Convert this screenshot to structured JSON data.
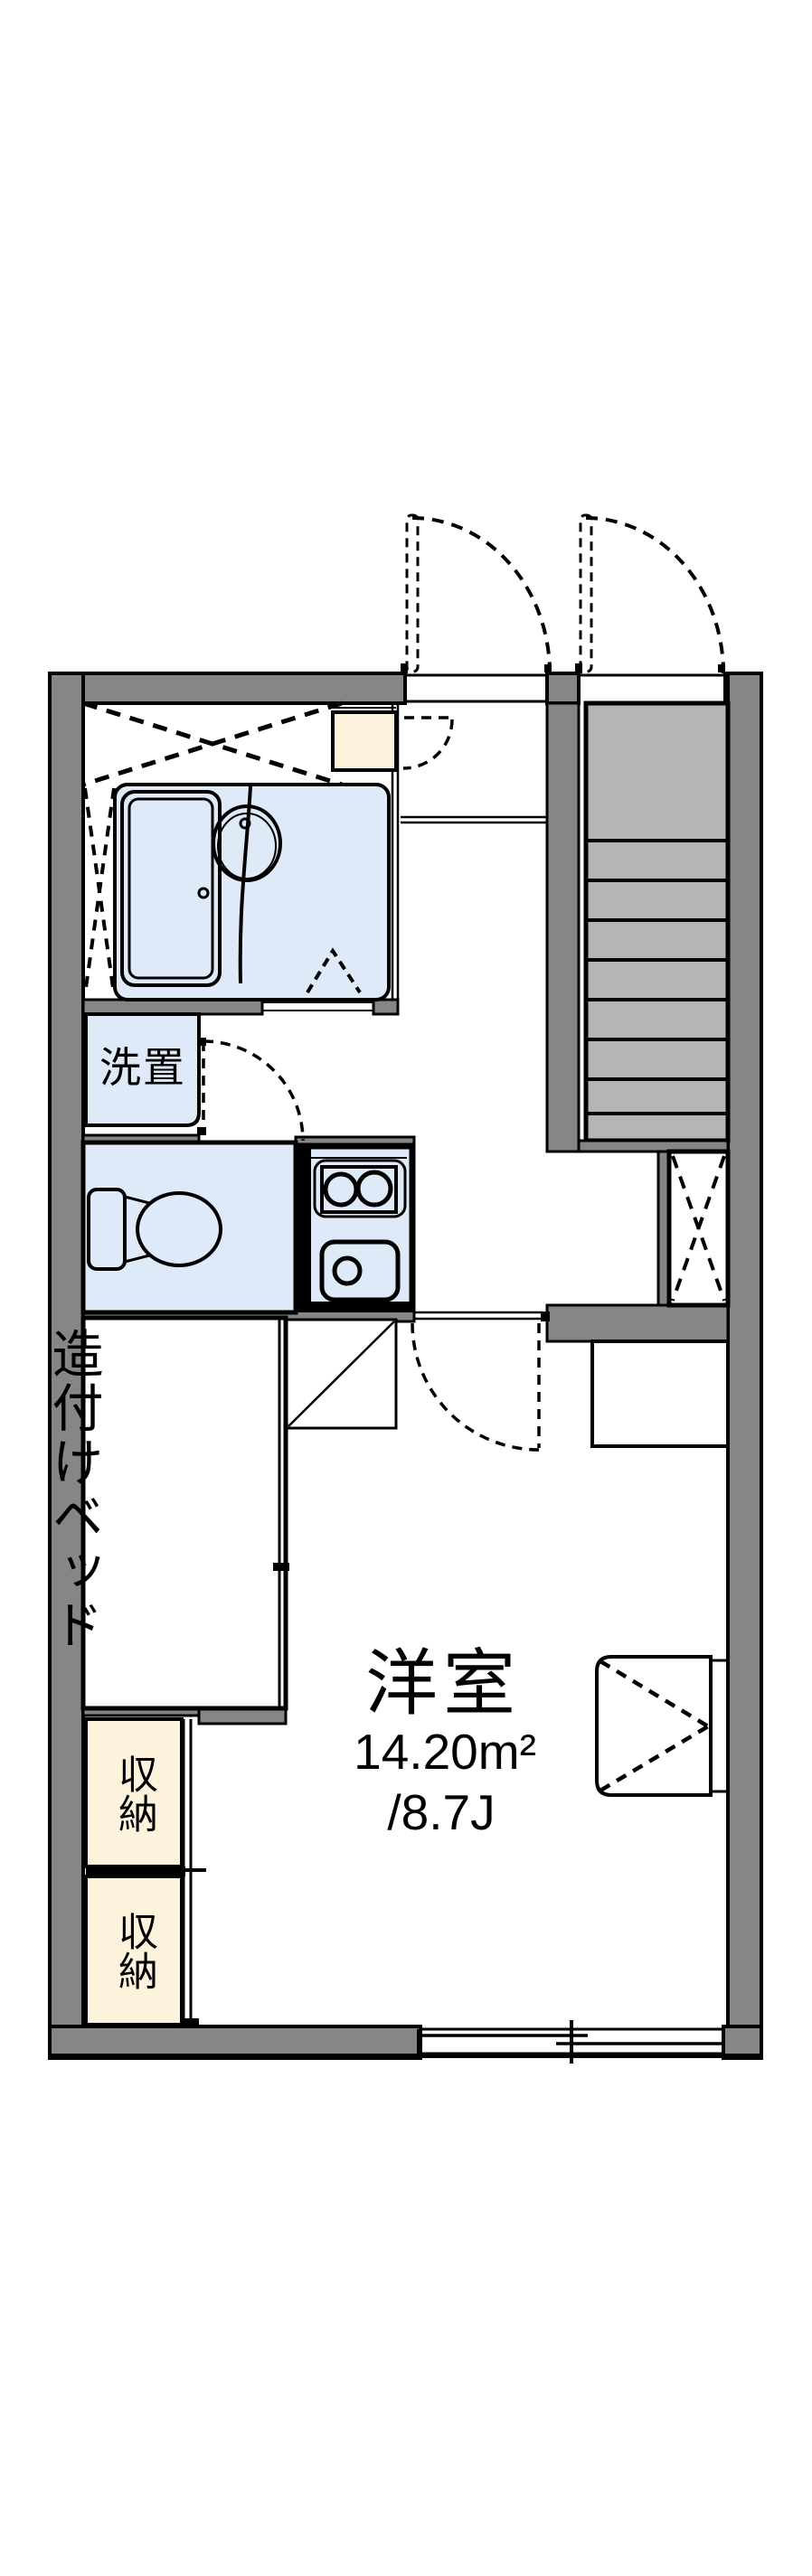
{
  "floorplan": {
    "type": "apartment-floor-plan",
    "labels": {
      "washer_space": "洗置",
      "built_in_bed_line1": "造付けベッド",
      "built_in_bed_line2": "（下部収納）",
      "storage_boxes": [
        {
          "label": "収納"
        },
        {
          "label": "収納"
        }
      ],
      "main_room": {
        "name": "洋室",
        "area_sqm": "14.20m²",
        "area_tatami": "/8.7J"
      }
    },
    "colors": {
      "background": "#ffffff",
      "wall_fill": "#868686",
      "stairs_fill": "#b5b5b5",
      "water_area_fill": "#dfeaf8",
      "storage_fill": "#fdf3dd",
      "line": "#000000"
    },
    "features": [
      "entry-double-doors-dashed",
      "unit-bath-with-tub-and-basin",
      "staircase-8-treads",
      "toilet-room",
      "kitchen-2-burner-stove-and-sink",
      "pipe-space-dashed-x",
      "built-in-bed-room",
      "two-storage-closets-sliding-doors",
      "air-conditioner-box",
      "counter",
      "bottom-sliding-window"
    ]
  }
}
